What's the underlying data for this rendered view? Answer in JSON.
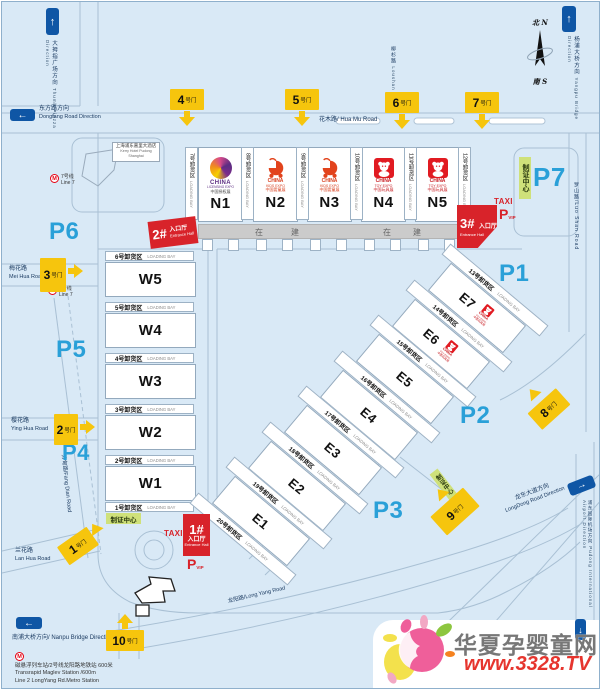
{
  "compass": {
    "north": "北 N",
    "south": "南 S"
  },
  "directions": {
    "thumb": {
      "zh": "大拇指广场方向",
      "en": "Thumb Piazza Direction"
    },
    "dongfang": {
      "zh": "东方路方向",
      "en": "Dongfang Road Direction"
    },
    "yangpu": {
      "zh": "杨浦大桥方向",
      "en": "Yangpu Bridge Direction"
    },
    "nanpu": {
      "zh": "南浦大桥方向/",
      "en": "Nanpu Bridge Direction"
    },
    "longdong": {
      "zh": "龙东大道方向",
      "en": "LongDong Road Direction"
    },
    "airport": {
      "zh": "浦东国际机场方向",
      "en": "Pudong International Airport Direction"
    }
  },
  "roads": {
    "huamu": "花木路/ Hua Mu Road",
    "loushan": {
      "zh": "柳杉路",
      "en": "Loushan Road"
    },
    "luoshan": "罗山路/Luo Shan Road",
    "meihua": {
      "zh": "梅花路",
      "en": "Mei Hua Road"
    },
    "yinghua": {
      "zh": "樱花路",
      "en": "Ying Hua Road"
    },
    "lanhua": {
      "zh": "兰花路",
      "en": "Lan Hua Road"
    },
    "fangdian": "芳甸路/Fang Dian Road",
    "longyang": "龙阳路/Long Yang Road"
  },
  "parking": [
    "P1",
    "P2",
    "P3",
    "P4",
    "P5",
    "P6",
    "P7"
  ],
  "gate_suffix": "号门",
  "gates": [
    "1",
    "2",
    "3",
    "4",
    "5",
    "6",
    "7",
    "8",
    "9",
    "10"
  ],
  "halls": {
    "north": [
      {
        "id": "N1",
        "logo": "licensing"
      },
      {
        "id": "N2",
        "logo": "kids"
      },
      {
        "id": "N3",
        "logo": "kids"
      },
      {
        "id": "N4",
        "logo": "toy"
      },
      {
        "id": "N5",
        "logo": "toy"
      }
    ],
    "west": [
      "W5",
      "W4",
      "W3",
      "W2",
      "W1"
    ],
    "east": [
      {
        "id": "E1"
      },
      {
        "id": "E2"
      },
      {
        "id": "E3"
      },
      {
        "id": "E4"
      },
      {
        "id": "E5"
      },
      {
        "id": "E6",
        "logo": "toy"
      },
      {
        "id": "E7",
        "logo": "toy"
      }
    ]
  },
  "loading_bays": {
    "north": [
      "7号卸货区",
      "8号卸货区",
      "9号卸货区",
      "10号卸货区",
      "11号卸货区",
      "12号卸货区"
    ],
    "west": [
      "6号卸货区",
      "5号卸货区",
      "4号卸货区",
      "3号卸货区",
      "2号卸货区",
      "1号卸货区"
    ],
    "east": [
      "13号卸货区",
      "14号卸货区",
      "15号卸货区",
      "16号卸货区",
      "17号卸货区",
      "18号卸货区",
      "19号卸货区",
      "20号卸货区"
    ],
    "en": "LOADING BAY"
  },
  "entrances": {
    "e1": {
      "num": "1#",
      "zh": "入口厅",
      "en": "Entrance Hall"
    },
    "e2": {
      "num": "2#",
      "zh": "入口厅",
      "en": "Entrance Hall"
    },
    "e3": {
      "num": "3#",
      "zh": "入口厅",
      "en": "Entrance Hall"
    }
  },
  "taxi": "TAXI",
  "vip_parking": {
    "p": "P",
    "vip": "VIP"
  },
  "badge_center": "制证中心",
  "under_construction": [
    "在",
    "建",
    "在",
    "建"
  ],
  "expos": {
    "licensing": {
      "line1": "CHINA",
      "line2": "LICENSING EXPO",
      "zh": "中国授权展"
    },
    "kids": {
      "line1": "CHINA",
      "line2": "KIDS EXPO",
      "zh": "中国婴童展"
    },
    "toy": {
      "line1": "CHINA",
      "line2": "TOY EXPO",
      "zh": "中国玩具展"
    }
  },
  "hotel": {
    "zh": "上海浦东嘉里大酒店",
    "en": "Kerry Hotel Pudong Shanghai"
  },
  "metro": {
    "line7_zh": "7号线",
    "line7_en": "Line 7",
    "note_zh": "磁悬浮列车站/2号线龙阳路地铁站  600米",
    "note_en1": "Transrapid Maglev Station  /600m",
    "note_en2": "Line 2 LongYang Rd.Metro Station"
  },
  "watermark": {
    "site": "华夏孕婴童网",
    "url": "www.3328.TV"
  },
  "colors": {
    "map_bg": "#d9e9f6",
    "gate_yellow": "#f6c50d",
    "entrance_red": "#d8232a",
    "parking_blue": "#2aa0d8",
    "badge_green": "#cfe17a",
    "arrow_blue": "#0f56a5",
    "toy_red": "#e11b22",
    "kids_orange": "#e2431c",
    "licensing_purple": "#5c2d82",
    "watermark_red": "#e6352e"
  }
}
